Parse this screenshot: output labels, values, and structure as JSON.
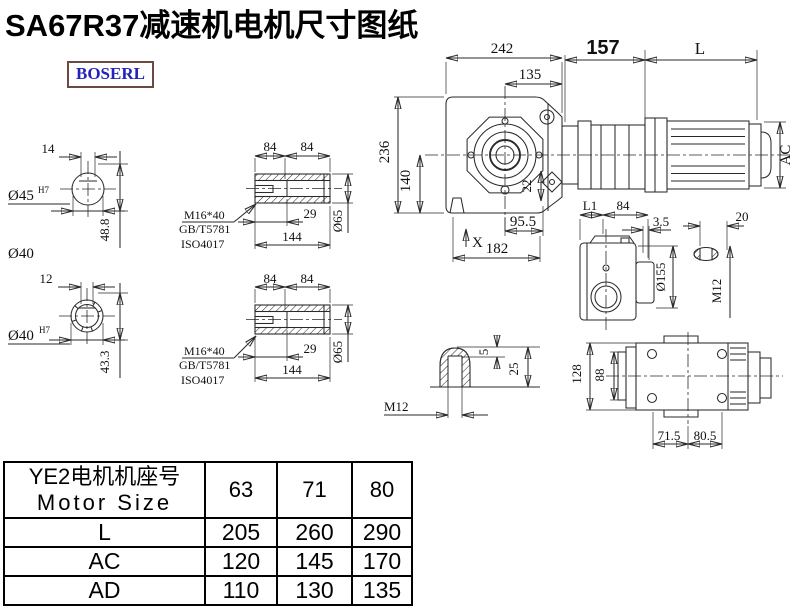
{
  "title": "SA67R37减速机电机尺寸图纸",
  "logo_text": "BOSERL",
  "colors": {
    "line": "#2a2a2a",
    "logo_text": "#2323bb",
    "logo_border": "#6b4a42",
    "title": "#000000"
  },
  "views": {
    "shaft_end_top": {
      "key_width": "14",
      "diameter": "Ø45",
      "tolerance": "H7",
      "height": "48.8",
      "extra_dia": "Ø40"
    },
    "shaft_end_bottom": {
      "key_width": "12",
      "diameter": "Ø40",
      "tolerance": "H7",
      "height": "43.3"
    },
    "hollow_shaft_top": {
      "seg1": "84",
      "seg2": "84",
      "thread": "M16*40",
      "std1": "GB/T5781",
      "std2": "ISO4017",
      "bore_depth": "29",
      "length": "144",
      "diameter": "Ø65"
    },
    "hollow_shaft_bottom": {
      "seg1": "84",
      "seg2": "84",
      "thread": "M16*40",
      "std1": "GB/T5781",
      "std2": "ISO4017",
      "bore_depth": "29",
      "length": "144",
      "diameter": "Ø65"
    },
    "front_view": {
      "overall_width": "242",
      "center_to_flange": "135",
      "gear_stage_length": "157",
      "motor_length": "L",
      "overall_height": "236",
      "axis_height": "140",
      "key": "22",
      "foot_offset": "95.5",
      "x_mark": "X",
      "base_length": "182",
      "motor_diameter": "AC"
    },
    "side_view": {
      "l1": "L1",
      "width": "84",
      "gap": "3.5",
      "flange_diameter": "Ø155",
      "boss": "20",
      "thread": "M12"
    },
    "plug_detail": {
      "tip_depth": "5",
      "length": "25",
      "thread": "M12"
    },
    "bottom_view": {
      "height": "128",
      "shaft_width": "88",
      "left_span": "71.5",
      "right_span": "80.5"
    }
  },
  "table": {
    "header_cn": "YE2电机机座号",
    "header_en": "Motor Size",
    "sizes": [
      "63",
      "71",
      "80"
    ],
    "rows": [
      {
        "label": "L",
        "values": [
          "205",
          "260",
          "290"
        ]
      },
      {
        "label": "AC",
        "values": [
          "120",
          "145",
          "170"
        ]
      },
      {
        "label": "AD",
        "values": [
          "110",
          "130",
          "135"
        ]
      }
    ]
  }
}
